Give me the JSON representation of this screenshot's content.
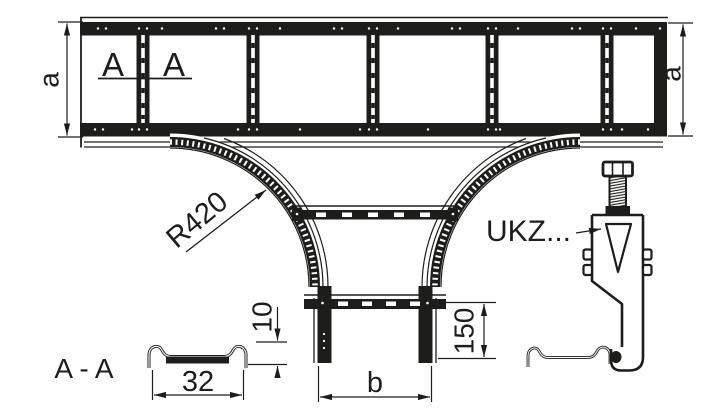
{
  "drawing": {
    "type": "technical-drawing",
    "subject": "cable ladder tee piece with clamp detail",
    "colors": {
      "line": "#1d1d1b",
      "background": "#ffffff"
    },
    "main_view": {
      "dim_a_left": "a",
      "dim_a_right": "a",
      "section_mark_left": "A",
      "section_mark_right": "A",
      "radius_label": "R420"
    },
    "branch": {
      "dim_b": "b",
      "dim_150": "150"
    },
    "section_aa": {
      "title": "A - A",
      "dim_width": "32",
      "dim_height": "10"
    },
    "clamp": {
      "label": "UKZ..."
    }
  }
}
